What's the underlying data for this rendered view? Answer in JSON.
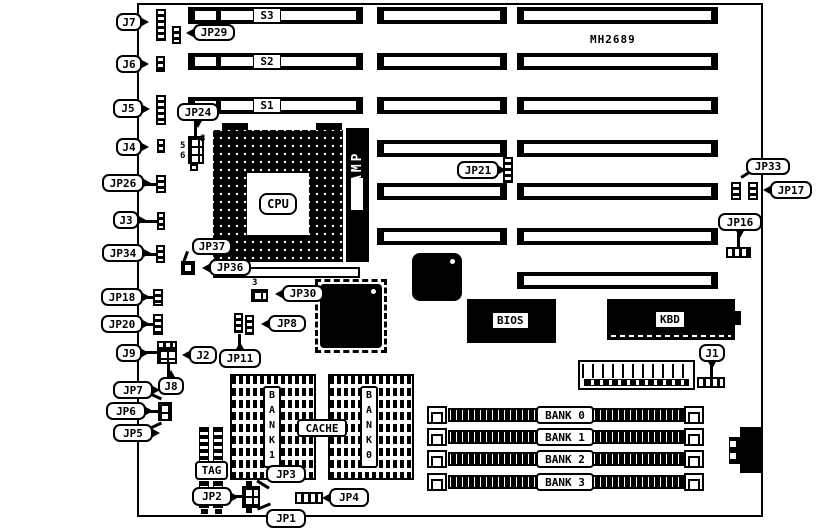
{
  "board": {
    "part_number": "MH2689"
  },
  "slots": {
    "s3": "S3",
    "s2": "S2",
    "s1": "S1"
  },
  "cpu": {
    "label": "CPU",
    "amp": "AMP"
  },
  "chips": {
    "bios": "BIOS",
    "kbd": "KBD",
    "cache": "CACHE",
    "tag": "TAG",
    "bank1_vertical": "B\nA\nN\nK\n1",
    "bank0_vertical": "B\nA\nN\nK\n0"
  },
  "simm_banks": {
    "bank0": "BANK 0",
    "bank1": "BANK 1",
    "bank2": "BANK 2",
    "bank3": "BANK 3"
  },
  "callouts": {
    "j7": "J7",
    "jp29": "JP29",
    "j6": "J6",
    "j5": "J5",
    "j4": "J4",
    "jp24": "JP24",
    "jp26": "JP26",
    "j3": "J3",
    "jp34": "JP34",
    "jp37": "JP37",
    "jp36": "JP36",
    "jp18": "JP18",
    "jp20": "JP20",
    "jp30": "JP30",
    "jp8": "JP8",
    "j9": "J9",
    "j2": "J2",
    "jp11": "JP11",
    "j8": "J8",
    "jp7": "JP7",
    "jp6": "JP6",
    "jp5": "JP5",
    "jp2": "JP2",
    "jp3": "JP3",
    "jp1": "JP1",
    "jp4": "JP4",
    "jp21": "JP21",
    "jp33": "JP33",
    "jp17": "JP17",
    "jp16": "JP16",
    "j1": "J1"
  },
  "pin_numbers": {
    "jp24_pin3": "3",
    "jp24_pin5": "5",
    "jp24_pin6": "6",
    "jp30_pin3": "3"
  },
  "colors": {
    "ink": "#000000",
    "paper": "#ffffff"
  }
}
